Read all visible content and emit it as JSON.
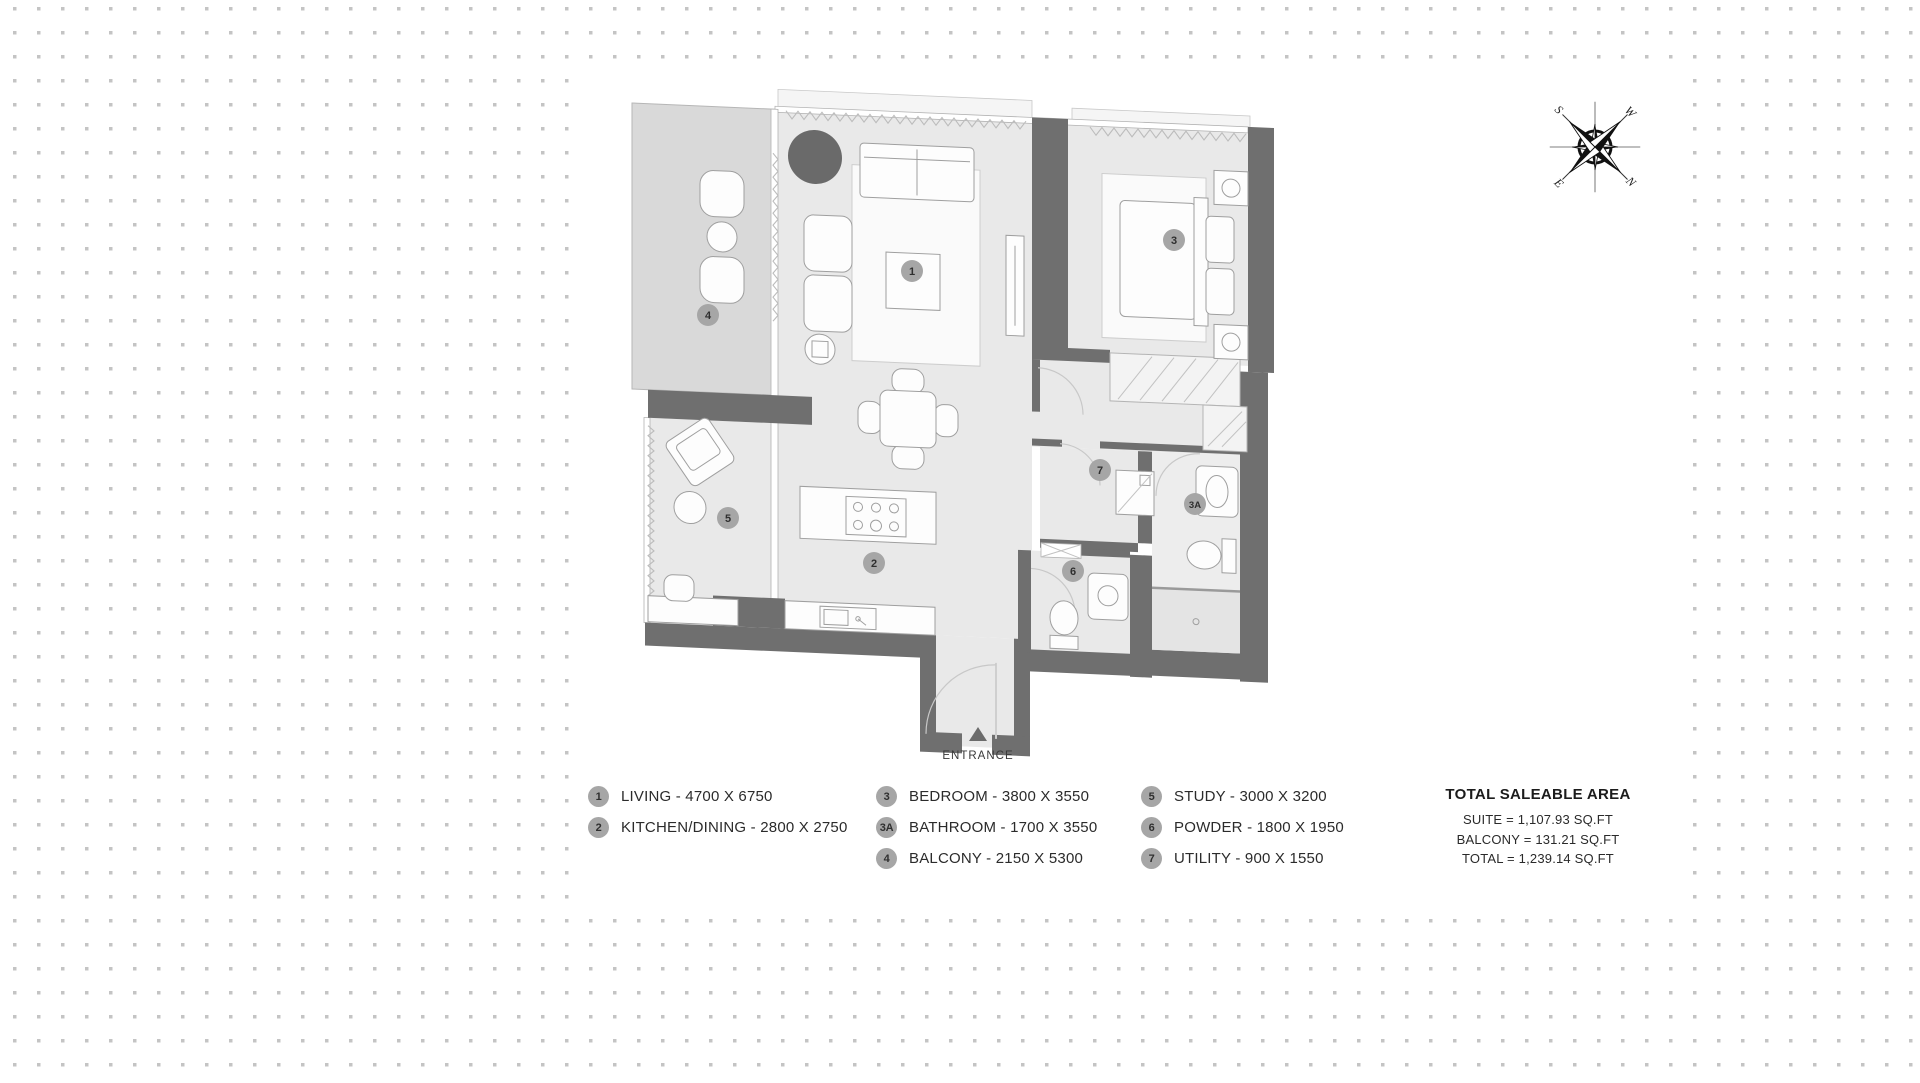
{
  "plan": {
    "entrance_label": "ENTRANCE",
    "badges": [
      "1",
      "2",
      "3",
      "3A",
      "4",
      "5",
      "6",
      "7"
    ],
    "colors": {
      "wall": "#6f6f6f",
      "floor": "#e9e9e9",
      "balcony_floor": "#d9d9d9",
      "badge": "#a6a6a6",
      "dot_grid": "#c4c4c4",
      "dark_accent": "#6a6a6a"
    }
  },
  "legend": {
    "columns": [
      {
        "items": [
          {
            "num": "1",
            "label": "LIVING - 4700 X 6750"
          },
          {
            "num": "2",
            "label": "KITCHEN/DINING - 2800 X 2750"
          }
        ]
      },
      {
        "items": [
          {
            "num": "3",
            "label": "BEDROOM - 3800 X 3550"
          },
          {
            "num": "3A",
            "label": "BATHROOM - 1700 X 3550"
          },
          {
            "num": "4",
            "label": "BALCONY - 2150 X 5300"
          }
        ]
      },
      {
        "items": [
          {
            "num": "5",
            "label": "STUDY - 3000 X 3200"
          },
          {
            "num": "6",
            "label": "POWDER - 1800 X 1950"
          },
          {
            "num": "7",
            "label": "UTILITY - 900 X 1550"
          }
        ]
      }
    ]
  },
  "totals": {
    "title": "TOTAL SALEABLE AREA",
    "lines": [
      "SUITE = 1,107.93 SQ.FT",
      "BALCONY = 131.21 SQ.FT",
      "TOTAL = 1,239.14 SQ.FT"
    ]
  },
  "compass": {
    "n": "N",
    "e": "E",
    "s": "S",
    "w": "W"
  }
}
